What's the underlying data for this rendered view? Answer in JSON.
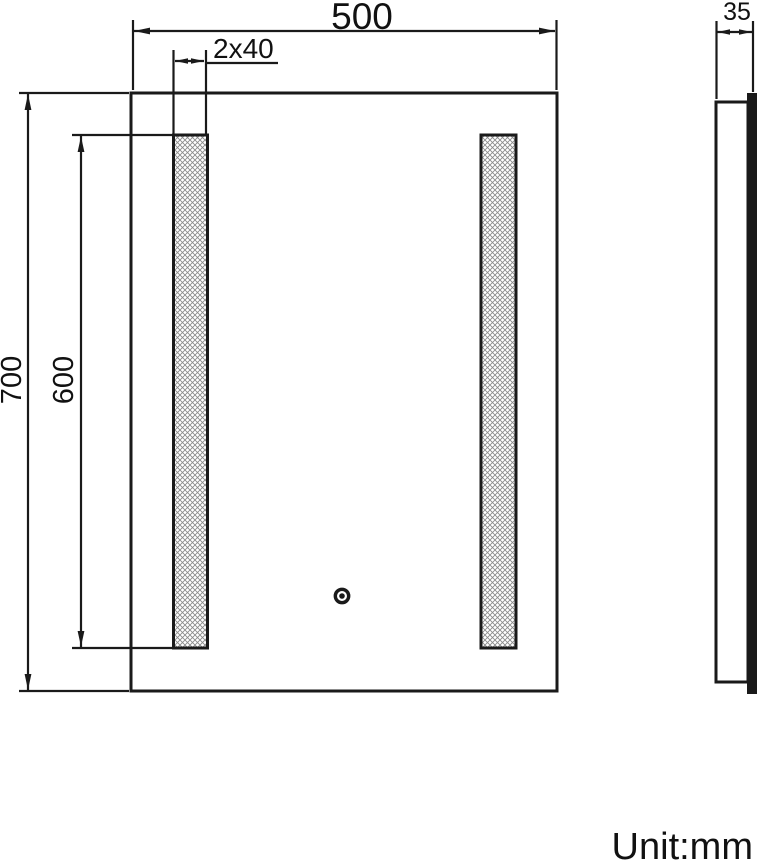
{
  "drawing": {
    "unit_note": "Unit:mm",
    "front_view": {
      "width_dim": "500",
      "height_dim": "700",
      "led_strip_width_dim": "2x40",
      "led_strip_height_dim": "600"
    },
    "side_view": {
      "depth_dim": "35"
    },
    "colors": {
      "line": "#1a1a1a",
      "hatch": "#8a8a8a",
      "background": "#ffffff"
    }
  }
}
